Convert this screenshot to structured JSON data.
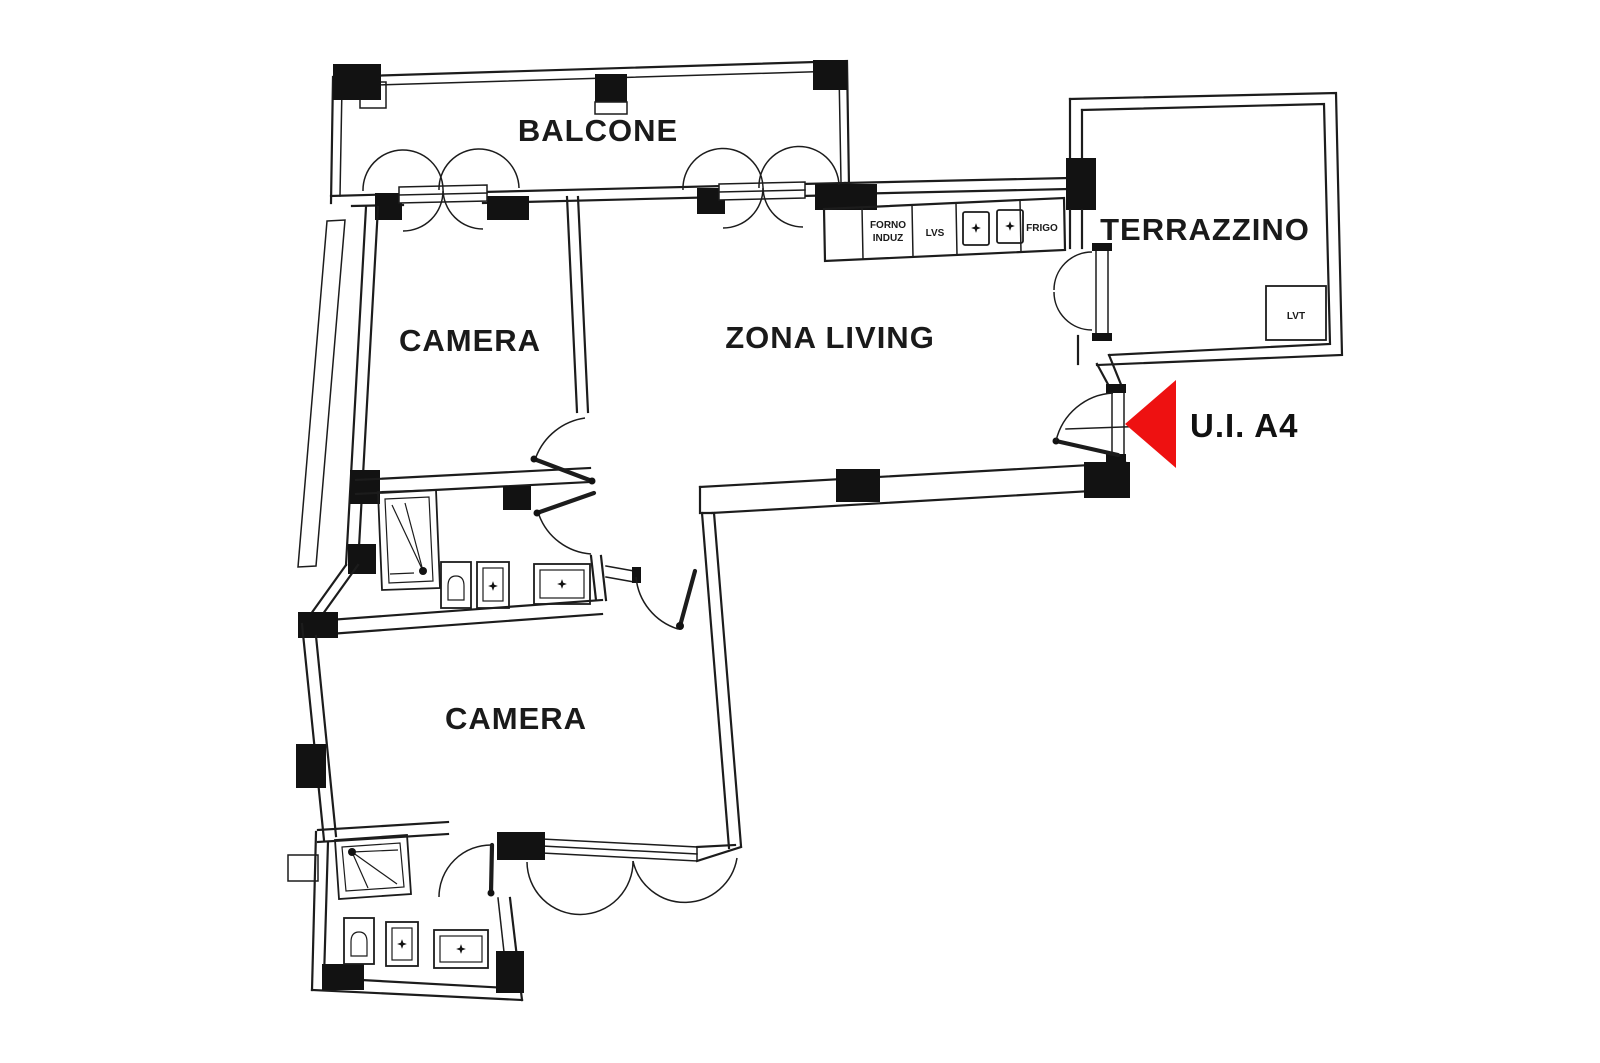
{
  "plan": {
    "rooms": {
      "balcone": {
        "label": "BALCONE"
      },
      "camera_1": {
        "label": "CAMERA"
      },
      "zona_living": {
        "label": "ZONA LIVING"
      },
      "terrazzino": {
        "label": "TERRAZZINO"
      },
      "camera_2": {
        "label": "CAMERA"
      }
    },
    "unit": {
      "label": "U.I. A4"
    },
    "kitchen": {
      "forno_line1": "FORNO",
      "forno_line2": "INDUZ",
      "lvs": "LVS",
      "frigo": "FRIGO"
    },
    "terrace_fixture": {
      "lvt": "LVT"
    },
    "colors": {
      "line": "#1c1c1c",
      "arrow": "#ee1111"
    }
  }
}
